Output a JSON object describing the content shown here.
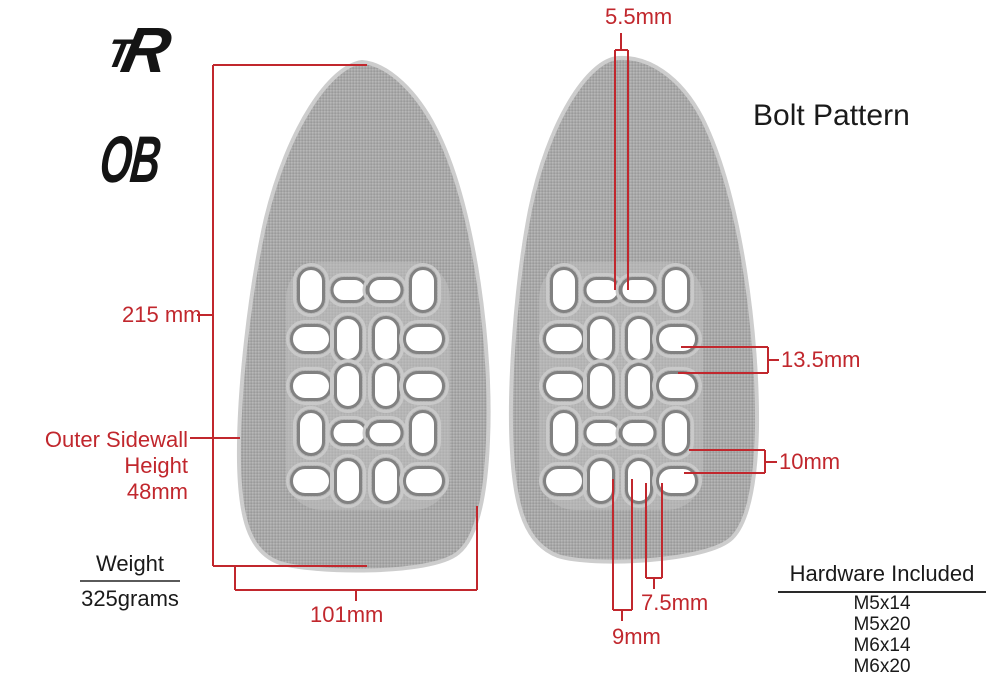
{
  "brand": {
    "logo_t": "T",
    "logo_r": "R",
    "model": "OB"
  },
  "dimensions": {
    "length": "215 mm",
    "sidewall_line1": "Outer Sidewall",
    "sidewall_line2": "Height",
    "sidewall_line3": "48mm",
    "width": "101mm",
    "bolt_top": "5.5mm",
    "bolt_right_upper": "13.5mm",
    "bolt_right_lower": "10mm",
    "bolt_bottom_outer": "7.5mm",
    "bolt_bottom_inner": "9mm"
  },
  "weight": {
    "title": "Weight",
    "value": "325grams"
  },
  "bolt_pattern": {
    "title": "Bolt Pattern"
  },
  "hardware": {
    "title": "Hardware Included",
    "items": [
      "M5x14",
      "M5x20",
      "M6x14",
      "M6x20"
    ]
  },
  "colors": {
    "dimension_red": "#c1272d",
    "text_black": "#1a1a1a",
    "pedal_gray": "#a8a8a8"
  }
}
